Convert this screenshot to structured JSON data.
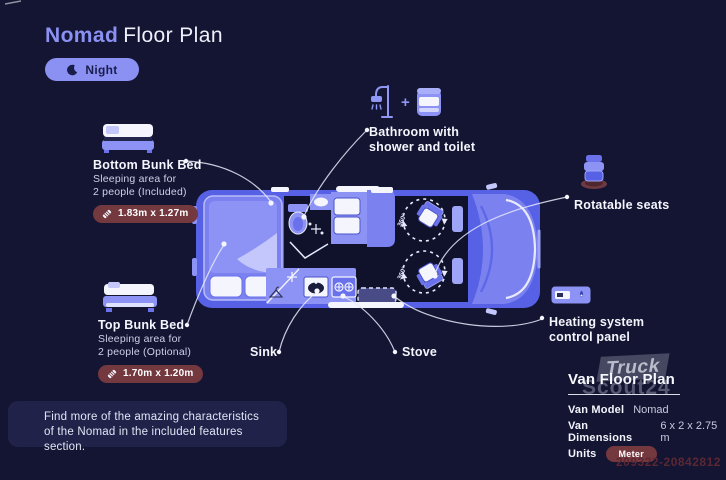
{
  "title": {
    "brand": "Nomad",
    "rest": "Floor Plan"
  },
  "mode_toggle": {
    "label": "Night"
  },
  "labels": {
    "bottom_bunk": {
      "title": "Bottom Bunk Bed",
      "desc_line1": "Sleeping area for",
      "desc_line2": "2 people (Included)",
      "dimensions": "1.83m x 1.27m"
    },
    "top_bunk": {
      "title": "Top Bunk Bed",
      "desc_line1": "Sleeping area for",
      "desc_line2": "2 people (Optional)",
      "dimensions": "1.70m x 1.20m"
    },
    "bathroom": {
      "plus": "+",
      "line1": "Bathroom with",
      "line2": "shower and toilet"
    },
    "rotatable_seats": {
      "label": "Rotatable seats"
    },
    "heating": {
      "line1": "Heating system",
      "line2": "control panel"
    },
    "sink": {
      "label": "Sink"
    },
    "stove": {
      "label": "Stove"
    }
  },
  "floor_plan": {
    "rotation_label": "360°"
  },
  "info_panel": {
    "heading": "Van Floor Plan",
    "rows": [
      {
        "label": "Van Model",
        "value": "Nomad"
      },
      {
        "label": "Van Dimensions",
        "value": "6 x 2 x 2.75 m"
      },
      {
        "label": "Units",
        "value": "Meter"
      }
    ]
  },
  "note": {
    "line1": "Find more of the amazing characteristics",
    "line2": "of the Nomad in the included features section."
  },
  "watermark": {
    "line1": "Truck",
    "line2": "Scout24"
  },
  "listing_id": "209322-20842812",
  "colors": {
    "background": "#141532",
    "accent": "#8b90f3",
    "van-blue": "#5661e6",
    "panel-light": "#8d93f4",
    "badge": "#74383f",
    "interior-dark": "#10122c"
  }
}
